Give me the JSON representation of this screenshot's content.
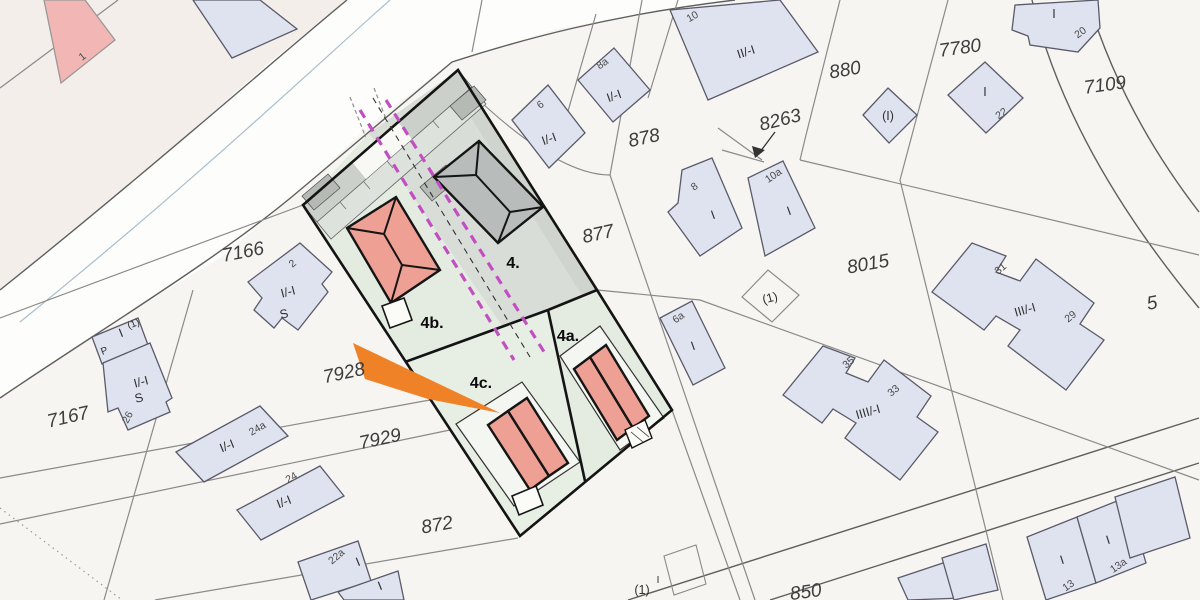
{
  "map_title": "Cadastral site plan",
  "colors": {
    "magenta": "#c24fc2",
    "orange": "#ef8226",
    "salmon": "#efa094",
    "gray_building": "#b8bcba",
    "existing_building": "#dfe3ef",
    "site_green": "#e4ebe1",
    "site_gray": "#d9ddd8"
  },
  "t": {
    "p7166": "7166",
    "p7167": "7167",
    "p7928": "7928",
    "p7929": "7929",
    "p872": "872",
    "p877": "877",
    "p878": "878",
    "p880": "880",
    "p8263": "8263",
    "p8015": "8015",
    "p7780": "7780",
    "p7109": "7109",
    "p850": "850",
    "p5": "5",
    "a4": "4.",
    "a4a": "4a.",
    "a4b": "4b.",
    "a4c": "4c.",
    "n1": "1",
    "n2": "2",
    "n6": "6",
    "n8a": "8a",
    "n10": "10",
    "n8": "8",
    "n10a": "10a",
    "n6a": "6a",
    "n20": "20",
    "n22": "22",
    "n31": "31",
    "n29": "29",
    "n35": "35",
    "n33": "33",
    "n24a": "24a",
    "n24": "24",
    "n22a": "22a",
    "n26": "26",
    "n13": "13",
    "n13a": "13a",
    "s2": "I/-I",
    "s2b": "S",
    "s6": "I/-I",
    "s8a": "I/-I",
    "s10": "II/-I",
    "s8": "I",
    "s10a": "I",
    "s6a": "I",
    "s20": "I",
    "s22": "I",
    "s3129": "III/-I",
    "s3533": "IIII/-I",
    "s24a": "I/-I",
    "s24": "I/-I",
    "s22a": "I",
    "s22a2": "I",
    "s26a": "I/-I",
    "s26b": "S",
    "sP": "P",
    "sPI": "I",
    "sP1": "(1)",
    "sDia": "(I)",
    "sPar1": "(1)",
    "sBot1": "(1)",
    "sBot1I": "I",
    "s13": "I",
    "s13a": "I"
  }
}
